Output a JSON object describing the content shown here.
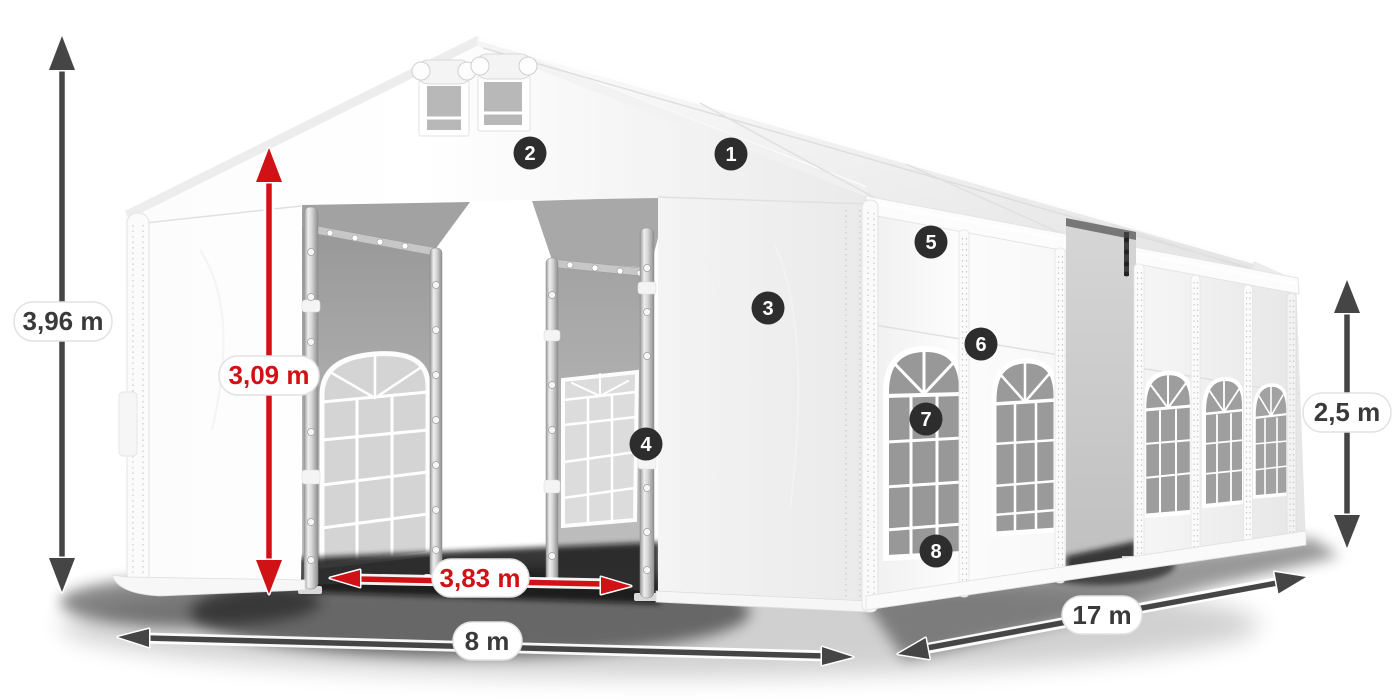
{
  "diagram": {
    "name": "party-tent-dimension-diagram",
    "dimensions": {
      "total_height": "3,96 m",
      "entrance_height": "3,09 m",
      "entrance_width": "3,83 m",
      "front_width": "8 m",
      "side_length": "17 m",
      "side_wall_height": "2,5 m"
    },
    "callouts": [
      "1",
      "2",
      "3",
      "4",
      "5",
      "6",
      "7",
      "8"
    ],
    "colors": {
      "dimension_red": "#d01116",
      "dimension_dark": "#454545",
      "label_text_dark": "#3a3a3a",
      "badge_background": "#2d2d2d",
      "badge_text": "#ffffff"
    }
  }
}
